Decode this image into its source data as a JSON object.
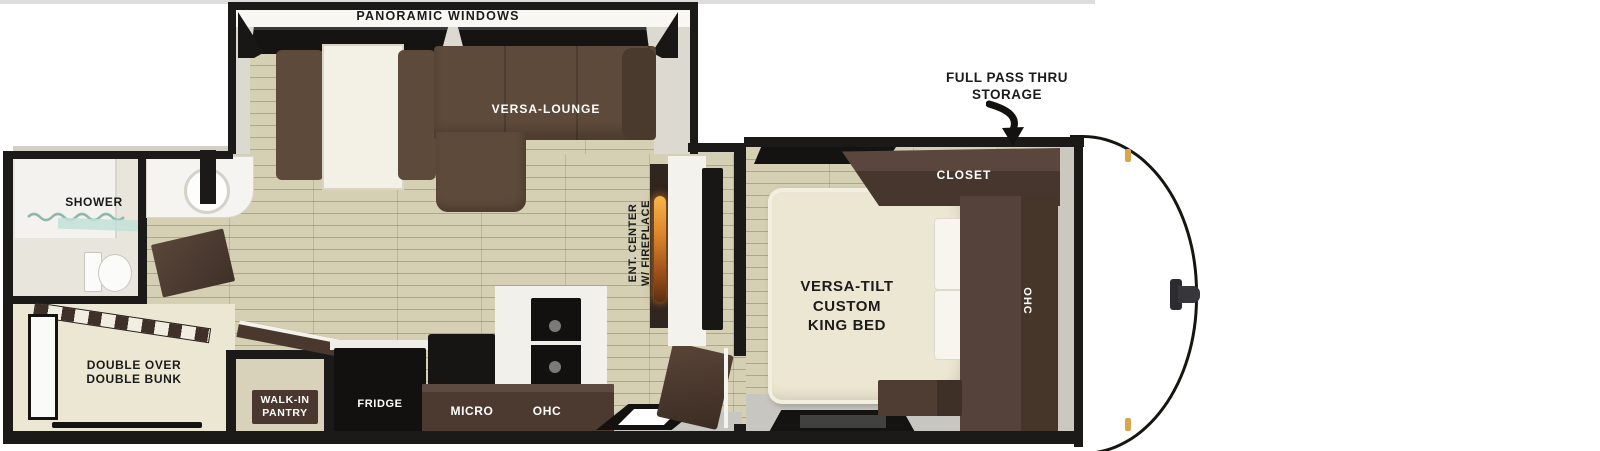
{
  "slideout": {
    "panoramic_windows_label": "PANORAMIC WINDOWS",
    "lounge_label": "VERSA-LOUNGE"
  },
  "living": {
    "ent_center_lines": [
      "ENT. CENTER",
      "W/ FIREPLACE"
    ]
  },
  "kitchen": {
    "fridge_label": "FRIDGE",
    "micro_label": "MICRO",
    "ohc_label": "OHC"
  },
  "bathroom": {
    "shower_label": "SHOWER"
  },
  "bunk_room": {
    "label_lines": [
      "DOUBLE OVER",
      "DOUBLE BUNK"
    ]
  },
  "pantry": {
    "label_lines": [
      "WALK-IN",
      "PANTRY"
    ]
  },
  "bedroom": {
    "bed_label_lines": [
      "VERSA-TILT",
      "CUSTOM",
      "KING BED"
    ],
    "closet_label": "CLOSET",
    "ohc_label": "OHC"
  },
  "exterior": {
    "storage_label_lines": [
      "FULL PASS THRU",
      "STORAGE"
    ]
  },
  "colors": {
    "exterior_wall": "#1c1a18",
    "floor_wood": "#d5cfb4",
    "floor_gray": "#c8c6c1",
    "cabinet_dark_brown": "#4a3830",
    "sofa_brown": "#5e4a3a",
    "mattress_cream": "#ece7d3",
    "flame_orange": "#e0862d",
    "marker_gold": "#d8a64b",
    "shower_glass_teal": "#a8d4c8"
  }
}
